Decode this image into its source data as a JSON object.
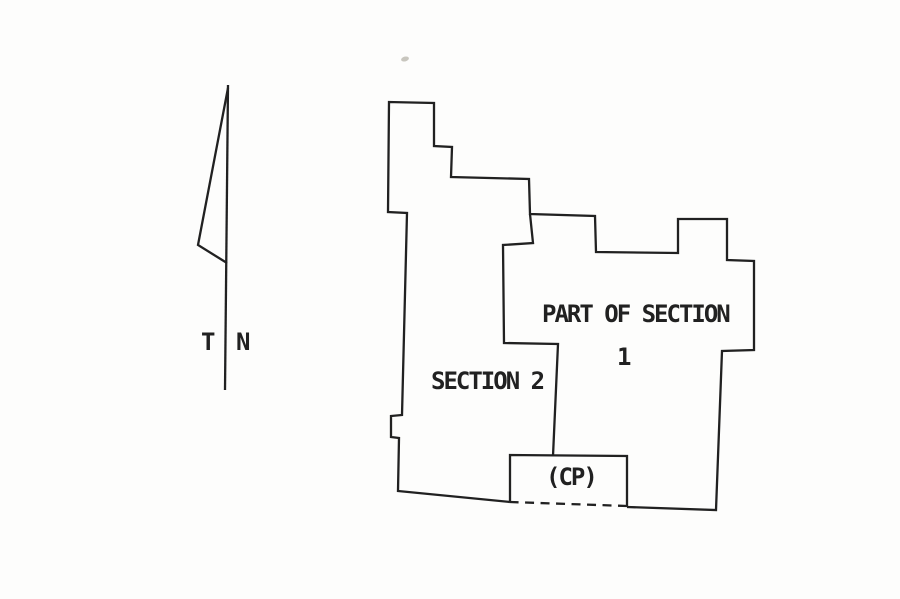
{
  "page": {
    "background": "#fdfdfc",
    "ink": "#212121",
    "artifact_color": "#c8c6be"
  },
  "north_arrow": {
    "label_true": "T",
    "label_north": "N",
    "shaft": [
      [
        228,
        85
      ],
      [
        225,
        390
      ]
    ],
    "pennant": [
      [
        228,
        88
      ],
      [
        198,
        245
      ],
      [
        227,
        263
      ]
    ]
  },
  "plat": {
    "labels": {
      "part_of_section": "PART OF SECTION",
      "section_one_number": "1",
      "section_two": "SECTION 2",
      "cp": "(CP)"
    },
    "paths": [
      {
        "name": "parcel-outline-solid",
        "dashed": false,
        "points": [
          [
            510,
            502
          ],
          [
            398,
            491
          ],
          [
            399,
            438
          ],
          [
            391,
            437
          ],
          [
            391,
            416
          ],
          [
            402,
            415
          ],
          [
            407,
            213
          ],
          [
            388,
            212
          ],
          [
            389,
            102
          ],
          [
            434,
            103
          ],
          [
            434,
            146
          ],
          [
            452,
            147
          ],
          [
            451,
            177
          ],
          [
            529,
            179
          ],
          [
            530,
            214
          ],
          [
            595,
            216
          ],
          [
            596,
            252
          ],
          [
            678,
            253
          ],
          [
            678,
            219
          ],
          [
            727,
            219
          ],
          [
            727,
            260
          ],
          [
            754,
            261
          ],
          [
            754,
            350
          ],
          [
            722,
            351
          ],
          [
            716,
            510
          ],
          [
            627,
            507
          ]
        ]
      },
      {
        "name": "parcel-outline-dashed-cp-segment",
        "dashed": true,
        "points": [
          [
            627,
            506
          ],
          [
            510,
            502
          ]
        ]
      },
      {
        "name": "section-division-line",
        "dashed": false,
        "points": [
          [
            530,
            214
          ],
          [
            533,
            243
          ],
          [
            503,
            245
          ],
          [
            504,
            343
          ],
          [
            558,
            344
          ],
          [
            553,
            456
          ]
        ]
      },
      {
        "name": "cp-parcel-box",
        "dashed": false,
        "points": [
          [
            510,
            502
          ],
          [
            510,
            455
          ],
          [
            627,
            456
          ],
          [
            627,
            507
          ]
        ]
      }
    ]
  }
}
